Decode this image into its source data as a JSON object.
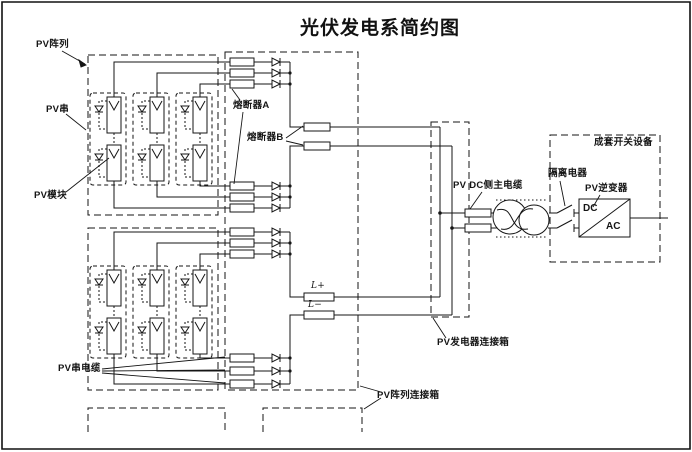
{
  "title": "光伏发电系简约图",
  "labels": {
    "pv_array": "PV阵列",
    "pv_string": "PV串",
    "pv_module": "PV模块",
    "fuse_a": "熔断器A",
    "fuse_b": "熔断器B",
    "pv_string_cable": "PV串电缆",
    "l_plus": "L+",
    "l_minus": "L−",
    "pv_dc_main_cable": "PV DC侧主电缆",
    "isolation_device": "隔离电器",
    "pv_inverter": "PV逆变器",
    "switchgear": "成套开关设备",
    "generator_junction_box": "PV发电器连接箱",
    "array_junction_box": "PV阵列连接箱",
    "dc": "DC",
    "ac": "AC"
  },
  "colors": {
    "line": "#151515",
    "background": "#ffffff"
  }
}
